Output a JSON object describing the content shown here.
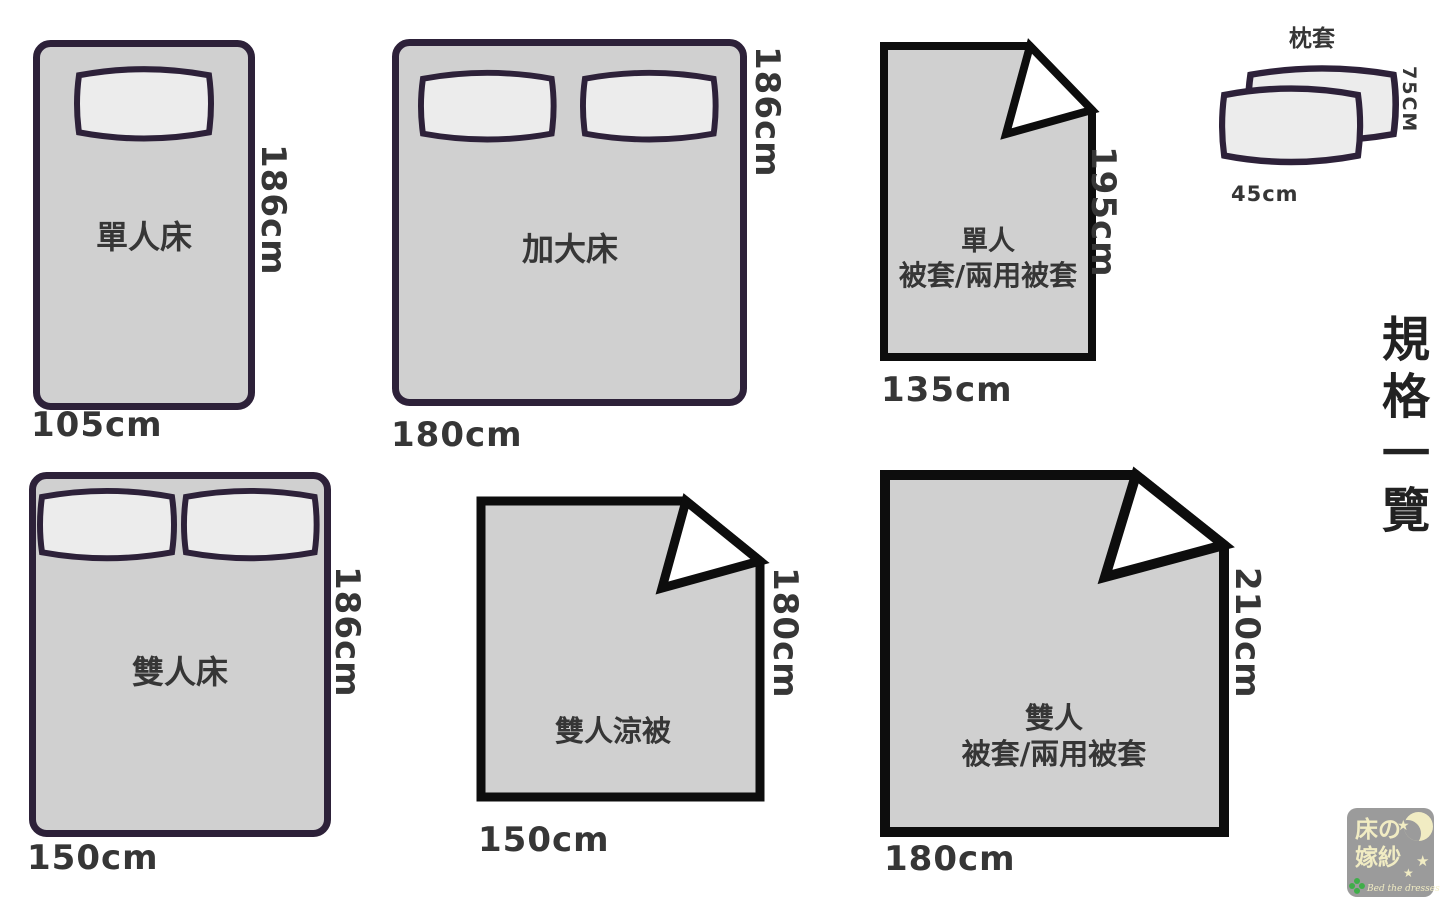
{
  "title": {
    "text": "規格一覽"
  },
  "sections": {
    "single_bed": {
      "label": "單人床",
      "width_label": "105cm",
      "height_label": "186cm"
    },
    "king_bed": {
      "label": "加大床",
      "width_label": "180cm",
      "height_label": "186cm"
    },
    "single_duvet": {
      "label_line1": "單人",
      "label_line2": "被套/兩用被套",
      "width_label": "135cm",
      "height_label": "195cm"
    },
    "pillowcase": {
      "label": "枕套",
      "width_label": "45cm",
      "height_label": "75CM"
    },
    "double_bed": {
      "label": "雙人床",
      "width_label": "150cm",
      "height_label": "186cm"
    },
    "double_quilt": {
      "label": "雙人涼被",
      "width_label": "150cm",
      "height_label": "180cm"
    },
    "double_duvet": {
      "label_line1": "雙人",
      "label_line2": "被套/兩用被套",
      "width_label": "180cm",
      "height_label": "210cm"
    }
  },
  "logo": {
    "name_line1": "床の",
    "name_line2": "嫁紗",
    "tagline": "Bed the dresses",
    "star_glyph": "★"
  },
  "colors": {
    "bed_fill": "#d0d0d0",
    "bed_border": "#2d2139",
    "quilt_border": "#0d0d0d",
    "pillow_fill": "#ececec",
    "text": "#363636",
    "title_text": "#222222",
    "logo_bg": "#9b9b9b",
    "logo_cream": "#f1ecc3",
    "logo_green": "#3fae49"
  }
}
